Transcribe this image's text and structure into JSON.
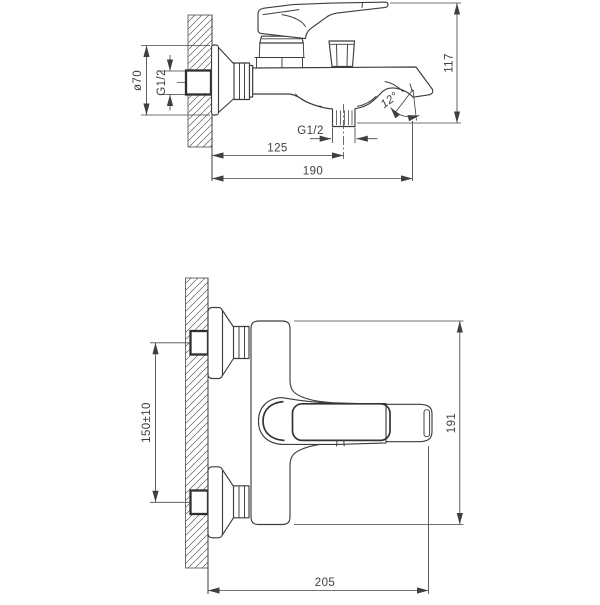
{
  "side_view": {
    "dimensions": {
      "escutcheon_diameter": "ø70",
      "inlet_thread": "G1/2",
      "overall_height": "117",
      "spout_angle": "12°",
      "shower_outlet_thread": "G1/2",
      "wall_to_shower_outlet": "125",
      "wall_to_spout_tip": "190"
    }
  },
  "plan_view": {
    "dimensions": {
      "inlet_centres_spacing": "150±10",
      "overall_length": "191",
      "wall_to_handle_tip": "205"
    }
  },
  "colors": {
    "line": "#3d3d3d",
    "dimension": "#464646",
    "background": "#ffffff"
  }
}
